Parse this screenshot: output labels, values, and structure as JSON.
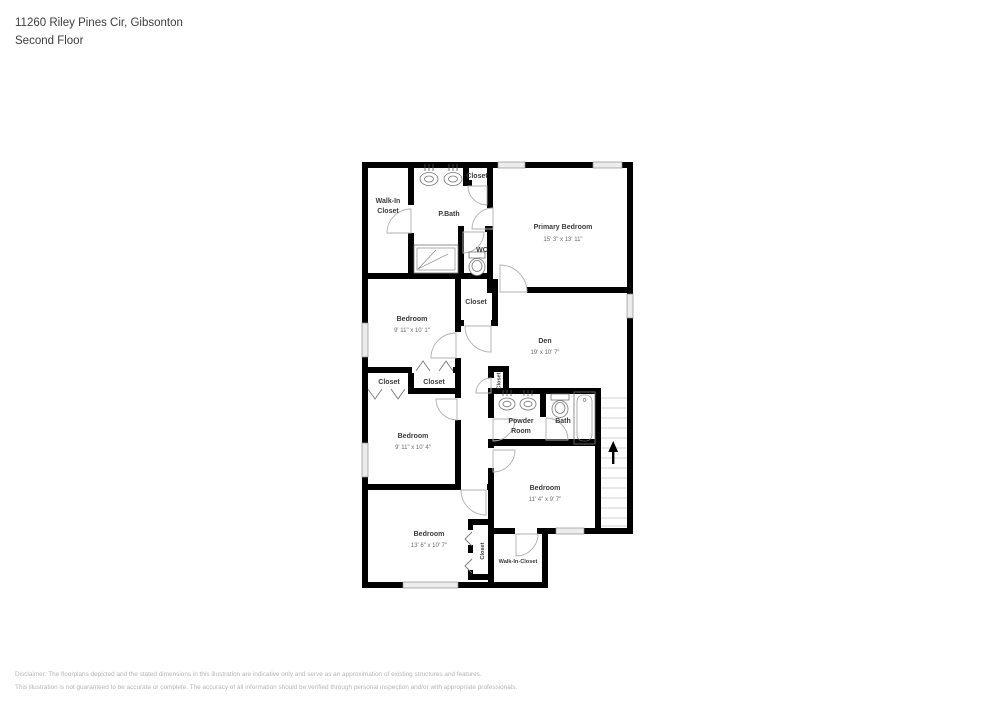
{
  "header": {
    "address": "11260 Riley Pines Cir, Gibsonton",
    "floor": "Second Floor"
  },
  "plan": {
    "rooms": {
      "walk_in_closet_top": {
        "line1": "Walk-In",
        "line2": "Closet"
      },
      "p_bath": {
        "label": "P.Bath"
      },
      "closet_top": {
        "label": "Closet"
      },
      "wc": {
        "label": "WC"
      },
      "primary_bedroom": {
        "label": "Primary Bedroom",
        "dims": "15' 3\" x 13' 11\""
      },
      "bedroom_nw": {
        "label": "Bedroom",
        "dims": "9' 11\" x 10' 1\""
      },
      "closet_mid": {
        "label": "Closet"
      },
      "den": {
        "label": "Den",
        "dims": "19' x 10' 7\""
      },
      "closet_left_a": {
        "label": "Closet"
      },
      "closet_left_b": {
        "label": "Closet"
      },
      "closet_den": {
        "label": "Closet"
      },
      "bedroom_w": {
        "label": "Bedroom",
        "dims": "9' 11\" x 10' 4\""
      },
      "powder_room": {
        "line1": "Powder",
        "line2": "Room"
      },
      "bath": {
        "label": "Bath"
      },
      "bedroom_se": {
        "label": "Bedroom",
        "dims": "11' 4\" x 9' 7\""
      },
      "bedroom_sw": {
        "label": "Bedroom",
        "dims": "13' 6\" x 10' 7\""
      },
      "closet_bottom": {
        "label": "Closet"
      },
      "walk_in_closet_bottom": {
        "label": "Walk-In-Closet"
      }
    }
  },
  "footer": {
    "line1": "Disclaimer: The floorplans depicted and the stated dimensions in this illustration are indicative only and serve as an approximation of existing structures and features.",
    "line2": "This illustration is not guaranteed to be accurate or complete. The accuracy of all information should be verified through personal inspection and/or with appropriate professionals."
  }
}
